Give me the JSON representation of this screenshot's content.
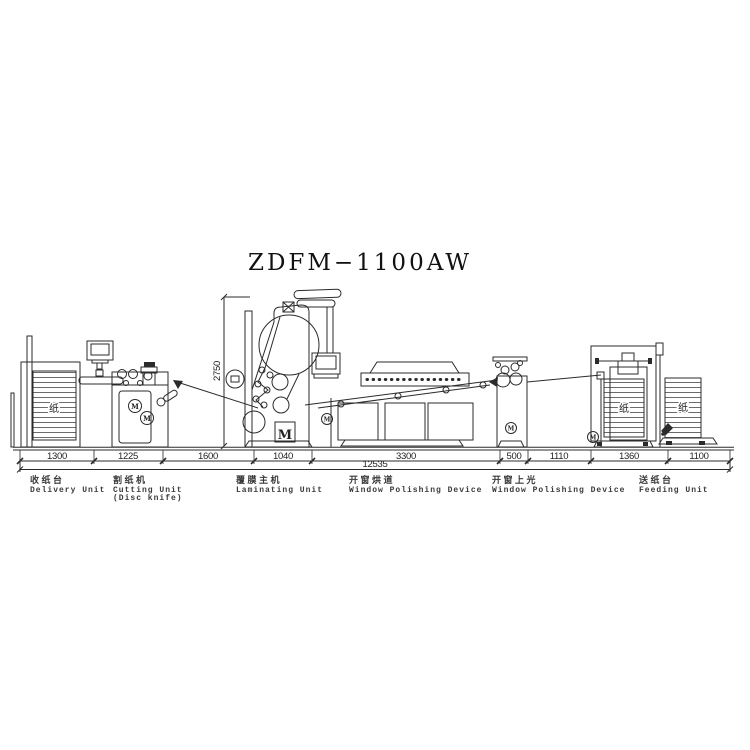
{
  "title": "ZDFM−1100AW",
  "dims": {
    "segments": [
      "1300",
      "1225",
      "1600",
      "1040",
      "3300",
      "500",
      "1110",
      "1360",
      "1100"
    ],
    "total": "12535",
    "height": "2750"
  },
  "labels": {
    "motor": "M",
    "paper": "纸",
    "units": [
      {
        "zh": "收纸台",
        "en1": "Delivery Unit"
      },
      {
        "zh": "割纸机",
        "en1": "Cutting Unit",
        "en2": "(Disc knife)"
      },
      {
        "zh": "覆膜主机",
        "en1": "Laminating Unit"
      },
      {
        "zh": "开窗烘道",
        "en1": "Window Polishing Device"
      },
      {
        "zh": "开窗上光",
        "en1": "Window Polishing Device"
      },
      {
        "zh": "送纸台",
        "en1": "Feeding Unit"
      }
    ]
  },
  "colors": {
    "line": "#2b2b2b",
    "background": "#ffffff",
    "text": "#222222"
  }
}
